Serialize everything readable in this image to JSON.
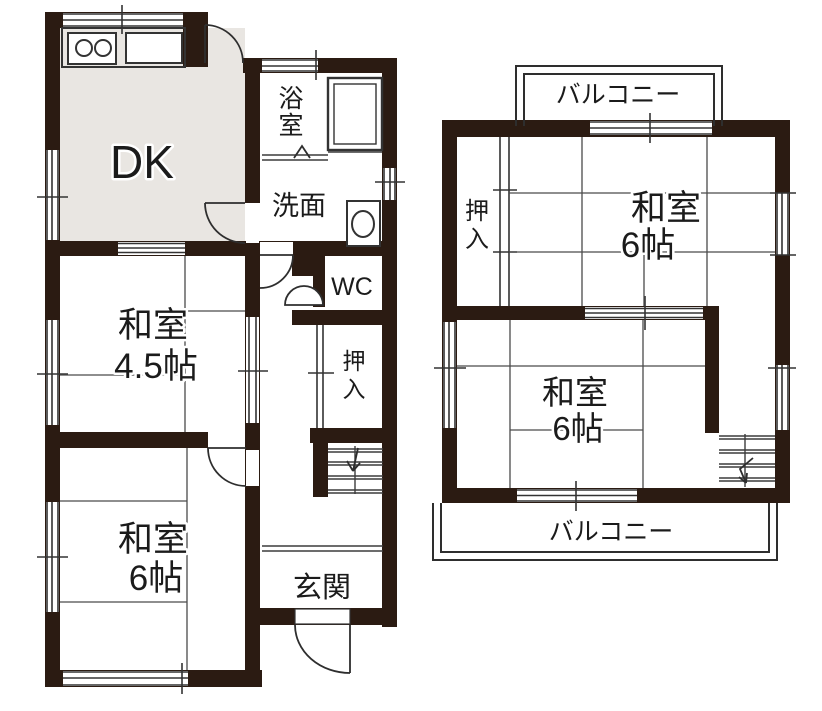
{
  "colors": {
    "wall": "#2b1b12",
    "line": "#3c3c3c",
    "floor": "#e9e6e2",
    "text": "#1b1b1b"
  },
  "floor1": {
    "dk": "DK",
    "bath_l1": "浴",
    "bath_l2": "室",
    "washroom": "洗面",
    "wc": "WC",
    "closet_l1": "押",
    "closet_l2": "入",
    "room45_l1": "和室",
    "room45_l2": "4.5帖",
    "room6_l1": "和室",
    "room6_l2": "6帖",
    "entrance": "玄関"
  },
  "floor2": {
    "balcony_top": "バルコニー",
    "closet_l1": "押",
    "closet_l2": "入",
    "room_a_l1": "和室",
    "room_a_l2": "6帖",
    "room_b_l1": "和室",
    "room_b_l2": "6帖",
    "balcony_bottom": "バルコニー"
  }
}
